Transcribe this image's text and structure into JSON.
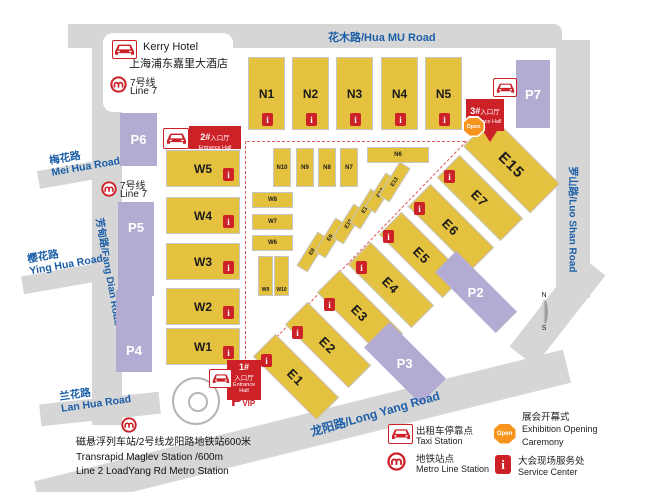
{
  "roads": {
    "huamu": "花木路/Hua MU Road",
    "luoshan": "罗山路/Luo Shan Road",
    "longyang": "龙阳路/Long Yang Road",
    "fangdian": "芳甸路/Fang Dian Road",
    "meihua_cn": "梅花路",
    "meihua_en": "Mei Hua Road",
    "yinghua_cn": "樱花路",
    "yinghua_en": "Ying Hua Road",
    "lanhua_cn": "兰花路",
    "lanhua_en": "Lan Hua Road"
  },
  "hotel": {
    "name_en": "Kerry Hotel",
    "name_cn": "上海浦东嘉里大酒店"
  },
  "metro7": {
    "cn": "7号线",
    "en": "Line 7"
  },
  "halls": {
    "n_big": [
      "N1",
      "N2",
      "N3",
      "N4",
      "N5"
    ],
    "n_small": [
      "N10",
      "N9",
      "N8",
      "N7"
    ],
    "n6": "N6",
    "w_big": [
      "W5",
      "W4",
      "W3",
      "W2",
      "W1"
    ],
    "w_small": [
      "W8",
      "W7",
      "W6"
    ],
    "w9": "W9",
    "w10": "W10",
    "e_big": [
      "E1",
      "E2",
      "E3",
      "E4",
      "E5",
      "E6",
      "E7"
    ],
    "e15": "E15",
    "e_small": [
      "E8",
      "E9",
      "E10",
      "E11",
      "E12",
      "E13"
    ]
  },
  "parking": {
    "p2": "P2",
    "p3": "P3",
    "p4": "P4",
    "p5": "P5",
    "p6": "P6",
    "p7": "P7"
  },
  "pvip": {
    "p": "P",
    "sub": "VIP"
  },
  "entrances": {
    "e1": {
      "num": "1#",
      "cn": "入口厅",
      "en": "Entrance Hall"
    },
    "e2": {
      "num": "2#",
      "cn": "入口厅",
      "en": "Entrance Hall"
    },
    "e3": {
      "num": "3#",
      "cn": "入口厅",
      "en": "Entrance Hall"
    }
  },
  "open_label": "Open",
  "i_label": "i",
  "compass": {
    "n": "N",
    "s": "S"
  },
  "legend": {
    "taxi_cn": "出租车停靠点",
    "taxi_en": "Taxi Station",
    "metro_cn": "地铁站点",
    "metro_en": "Metro Line Station",
    "open_cn": "展会开幕式",
    "open_en1": "Exhibition Opening",
    "open_en2": "Caremony",
    "service_cn": "大会现场服务处",
    "service_en": "Service Center"
  },
  "footnote": {
    "l1": "磁悬浮列车站/2号线龙阳路地铁站600米",
    "l2": "Transrapid Maglev Station /600m",
    "l3": "Line 2 LoadYang Rd Metro Station"
  },
  "colors": {
    "hall": "#e4c13f",
    "parking": "#b3abd2",
    "road": "#d6d6d6",
    "red": "#cc2127",
    "blue": "#1c5fa8",
    "orange": "#f7941d",
    "ink": "#1a1a1a"
  }
}
